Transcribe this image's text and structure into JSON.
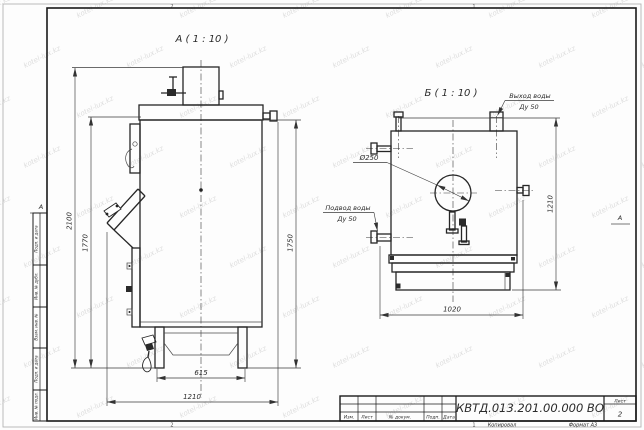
{
  "sheet": {
    "footer": {
      "copied": "Копировал",
      "format": "Формат А3"
    },
    "zones": {
      "top_left": "2",
      "top_right": "1",
      "bottom_left": "2",
      "bottom_right": "1",
      "side_left": "А",
      "side_right": "А"
    }
  },
  "watermark": {
    "text": "kotel-lux.kz"
  },
  "margin_columns": [
    {
      "label": "Подп. и дата"
    },
    {
      "label": "Инв. № дубл."
    },
    {
      "label": "Взам. инв. №"
    },
    {
      "label": "Подп. и дата"
    },
    {
      "label": "Инв. № подл."
    }
  ],
  "title_block": {
    "designation": "КВТД.013.201.00.000 ВО",
    "sheet_label": "Лист",
    "sheet_number": "2",
    "revision_columns": [
      "Изм.",
      "Лист",
      "№ докум.",
      "Подп.",
      "Дата"
    ]
  },
  "view_a": {
    "title": "А ( 1 : 10 )",
    "dim_total_height": "2100",
    "dim_height_1770": "1770",
    "dim_height_1750": "1750",
    "dim_base_width": "615",
    "dim_depth": "1210"
  },
  "view_b": {
    "title": "Б ( 1 : 10 )",
    "flue_diameter": "Ø250",
    "outlet_label_line1": "Выход воды",
    "outlet_label_line2": "Ду 50",
    "inlet_label_line1": "Подвод воды",
    "inlet_label_line2": "Ду 50",
    "dim_width": "1020",
    "dim_height": "1210"
  }
}
